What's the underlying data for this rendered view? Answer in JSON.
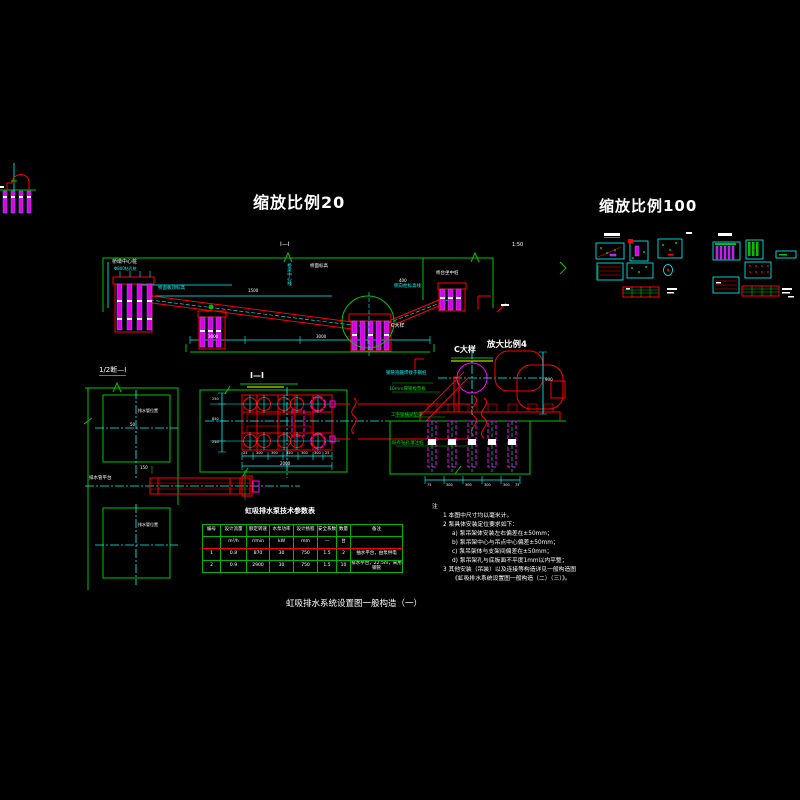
{
  "colors": {
    "background": "#000000",
    "frame_green": "#00c300",
    "dimension_cyan": "#00ffff",
    "structure_red": "#ff0000",
    "pile_magenta": "#ff00ff",
    "text_white": "#ffffff",
    "underline_yellow": "#ffff00"
  },
  "titles": {
    "scale20": "缩放比例20",
    "scale100": "缩放比例100",
    "section_half": "1/2断—Ⅰ",
    "plan": "Ⅰ—Ⅰ",
    "section_cut": "Ⅰ—Ⅰ",
    "detail_c": "C大样",
    "detail_scale": "放大比例4",
    "ratio_small": "1:50",
    "bottom_caption": "虹吸排水系统设置图一般构造（一）"
  },
  "elevation": {
    "left_pier": "桥墩中心桩",
    "left_pier_sub": "Φ800钻孔桩",
    "deck_level": "桥面板顶标高",
    "bridge_cl": "桥梁中心线",
    "deck_label": "桥面标高",
    "right_abut": "桥台坐中桩",
    "side_level": "侧向栓标高线",
    "c_ref": "C大样",
    "dim_400": "400",
    "dim_1500": "1500",
    "dim_3000a": "3000",
    "dim_3000b": "3000"
  },
  "section": {
    "inner_label": "排水管位置",
    "inner_label2": "排水管位置",
    "dim_50": "50",
    "dim_150": "150",
    "beam_label": "排水管平台"
  },
  "plan_view": {
    "dim_left_vals": [
      "250",
      "850",
      "250"
    ],
    "dims_bottom": [
      "25",
      "300",
      "300",
      "350",
      "300",
      "300",
      "25"
    ],
    "dim_total": "2000"
  },
  "detail": {
    "leader1": "钢管抱箍焊接于钢桩",
    "leader2": "10mm厚钢板垫板",
    "leader3": "工字钢横梁垫梁",
    "leader4": "既有钻孔灌注桩",
    "dim_right": "900",
    "dims_bottom": [
      "75",
      "300",
      "300",
      "300",
      "300",
      "75"
    ]
  },
  "table": {
    "title": "虹吸排水泵技术参数表",
    "headers": [
      "编号",
      "设计流量",
      "额定转速",
      "水泵功率",
      "设计扬程",
      "安全系数",
      "数量",
      "备注"
    ],
    "units": [
      "",
      "m³/h",
      "r/min",
      "kW",
      "mm",
      "—",
      "台",
      ""
    ],
    "rows": [
      [
        "1",
        "0.8",
        "870",
        "30",
        "750",
        "1.5",
        "2",
        "抽水平台，由泵供电"
      ],
      [
        "2",
        "0.9",
        "2900",
        "30",
        "750",
        "1.5",
        "10",
        "排水平台，22.5m，采用钢管"
      ]
    ]
  },
  "notes": {
    "header": "注",
    "items": [
      "1  本图中尺寸均以毫米计。",
      "2  泵具体安装定位要求如下：",
      "a) 泵吊架体安装左右偏差在±50mm；",
      "b) 泵吊架中心与吊点中心偏差±50mm；",
      "c) 泵吊架体与支架间偏差在±50mm；",
      "d) 泵吊架孔与底板面不平度1mm以内平整；",
      "3  其他安装（吊装）以及连接等构造详见一般构造图",
      "《虹吸排水系统设置图一般构造（二）（三）》。"
    ]
  }
}
